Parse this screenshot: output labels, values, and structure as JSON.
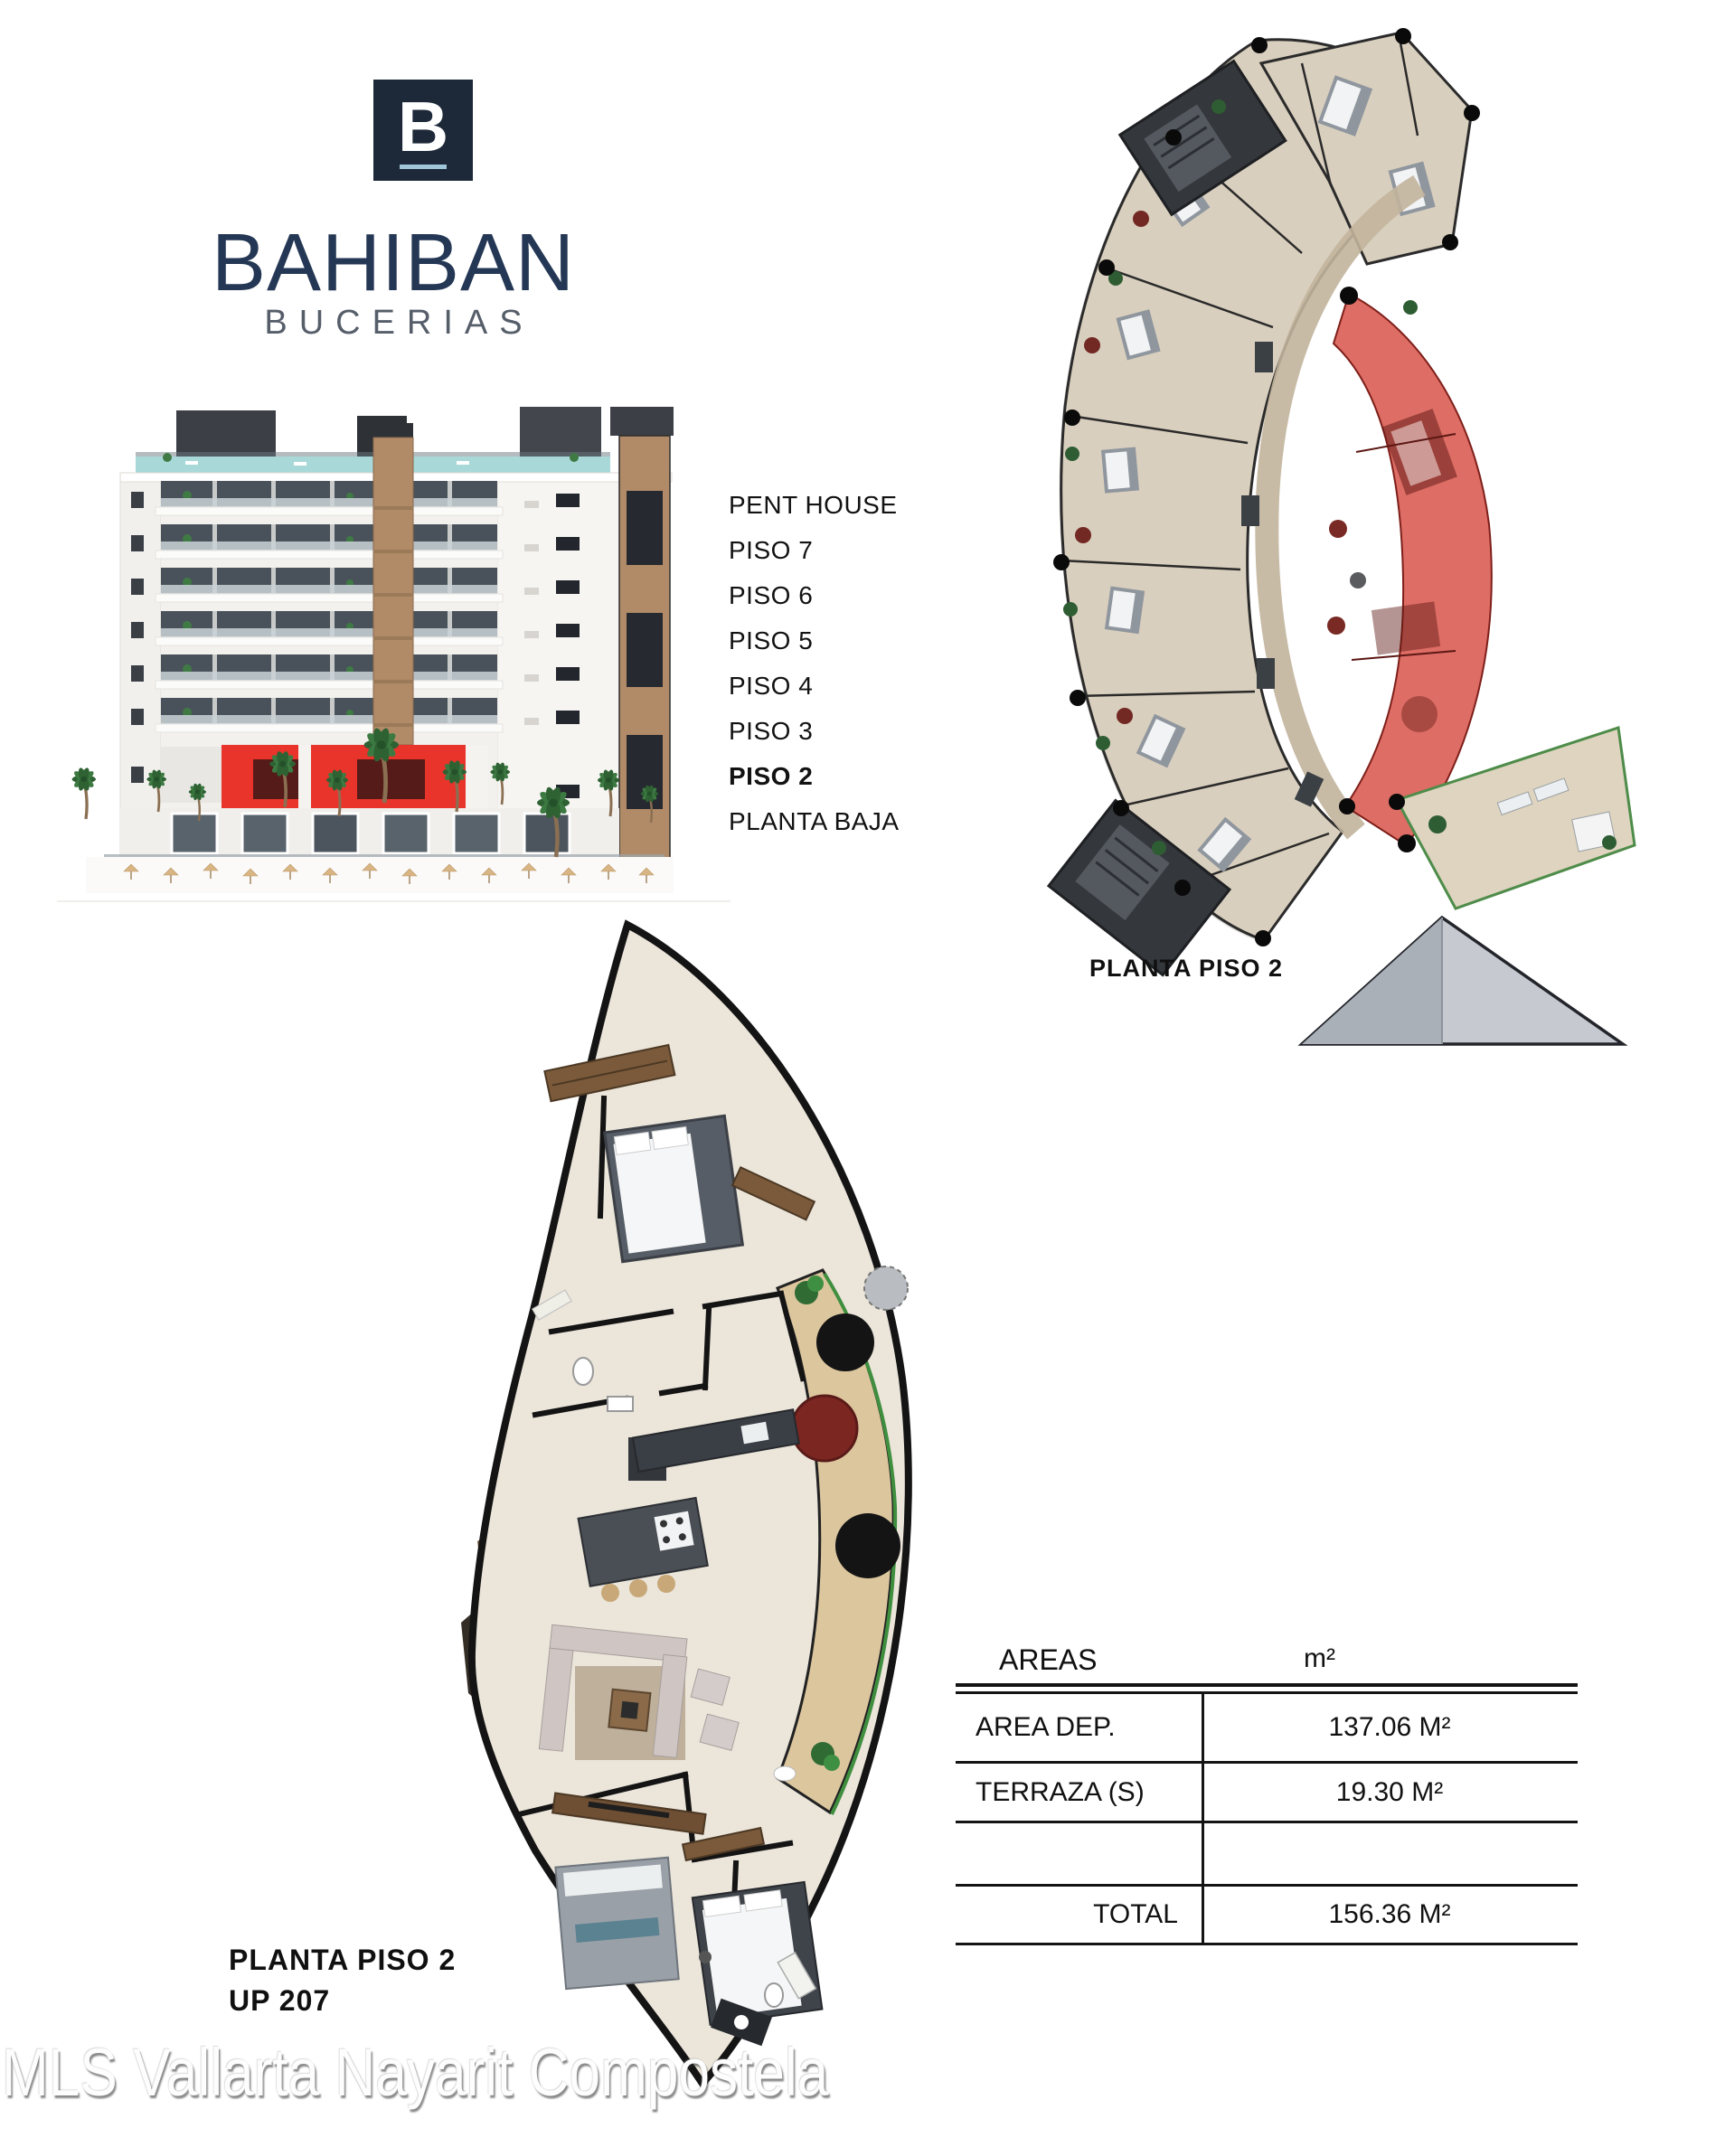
{
  "brand": {
    "logo_letter": "B",
    "name": "BAHIBAN",
    "subtitle": "BUCERIAS"
  },
  "elevation": {
    "floors": [
      "PENT HOUSE",
      "PISO 7",
      "PISO 6",
      "PISO 5",
      "PISO 4",
      "PISO 3",
      "PISO 2",
      "PLANTA BAJA"
    ],
    "highlighted_floor": "PISO 2"
  },
  "floor_plan_overview": {
    "caption": "PLANTA PISO 2"
  },
  "unit_plan": {
    "caption_line1": "PLANTA PISO 2",
    "caption_line2": "UP 207"
  },
  "areas_table": {
    "header": {
      "label": "AREAS",
      "unit": "m²"
    },
    "rows": [
      {
        "label": "AREA DEP.",
        "value": "137.06 M²"
      },
      {
        "label": "TERRAZA (S)",
        "value": "19.30 M²"
      },
      {
        "label": "",
        "value": ""
      },
      {
        "label": "TOTAL",
        "value": "156.36 M²"
      }
    ]
  },
  "watermark": "MLS Vallarta Nayarit Compostela",
  "colors": {
    "brand_navy": "#1d2939",
    "brand_text_navy": "#243754",
    "subtitle_gray": "#565e6a",
    "accent_red": "#e9342b",
    "unit_highlight_red": "#d4443a",
    "plan_floor_tan": "#d9cfbe",
    "terrace_wood": "#dcc69e",
    "terrace_green_edge": "#3f8f3f"
  }
}
